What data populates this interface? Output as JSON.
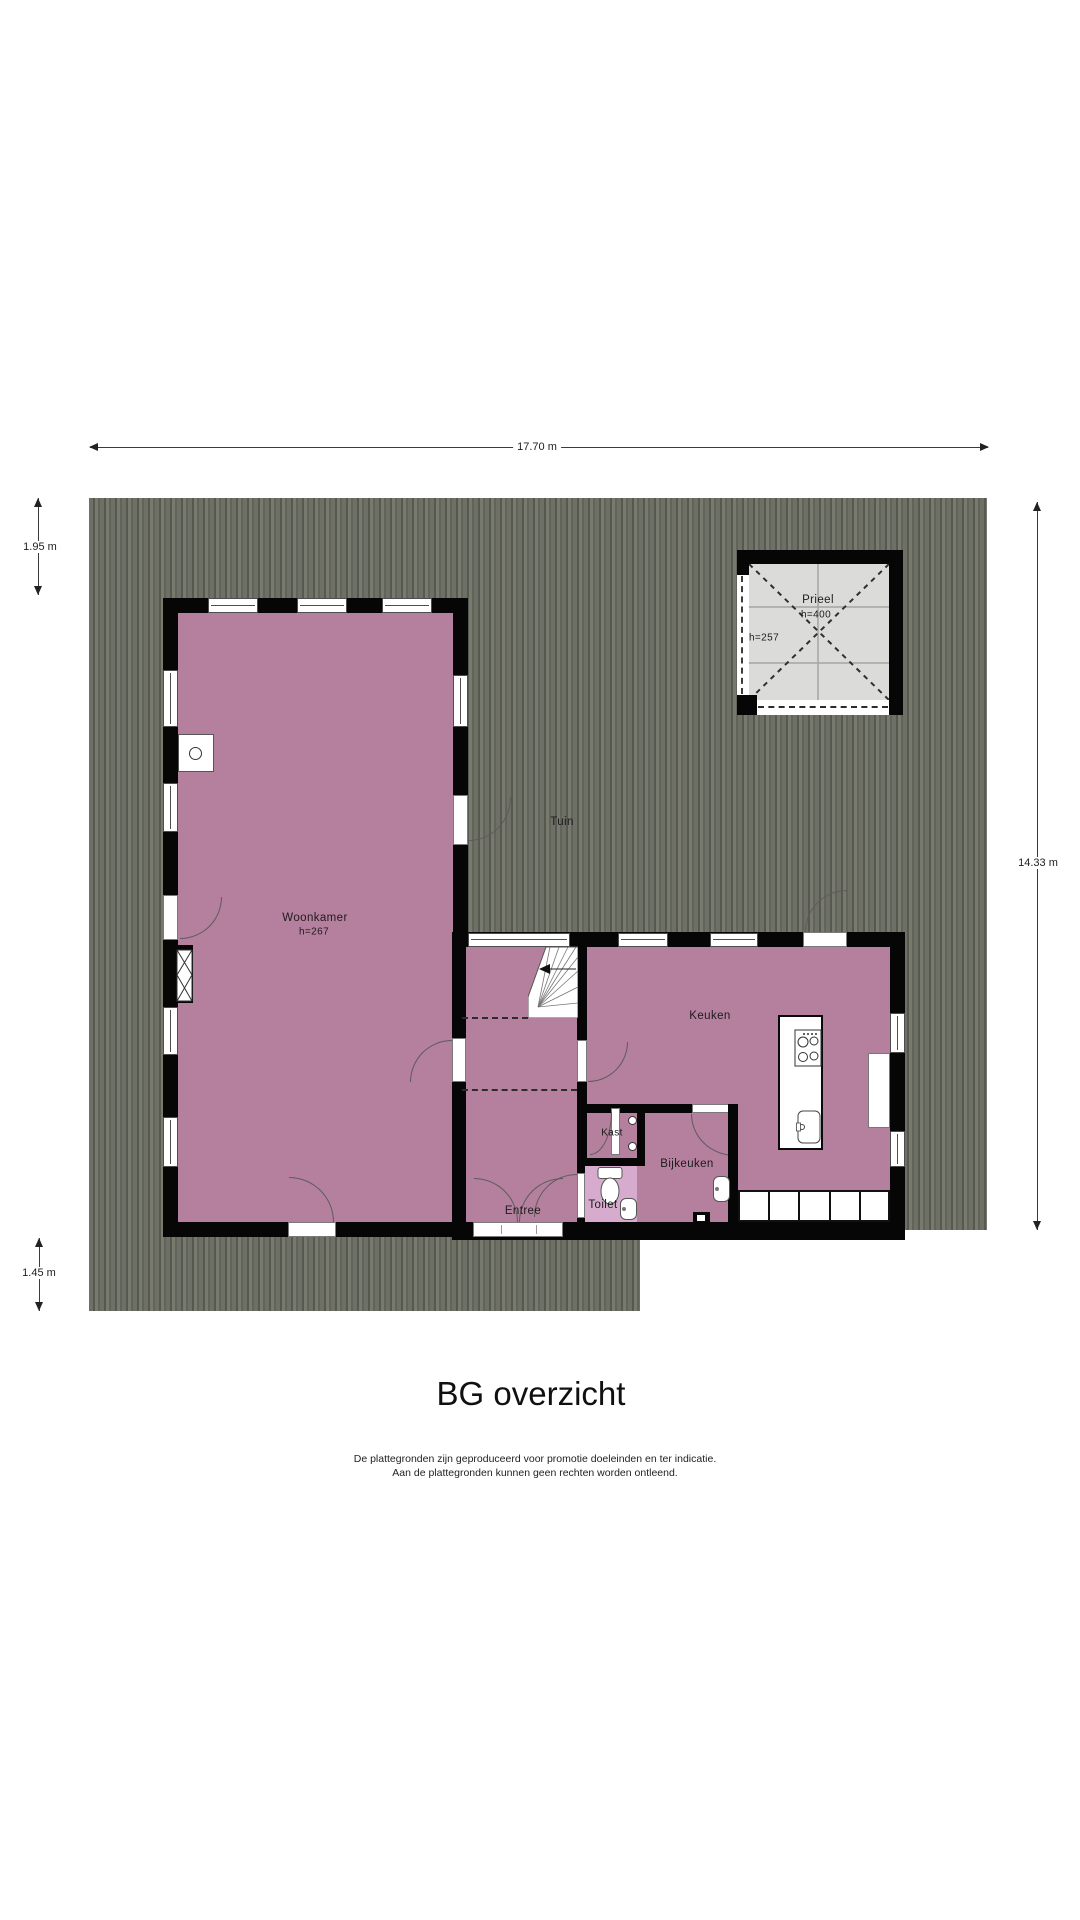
{
  "title": "BG overzicht",
  "disclaimer": {
    "line1": "De plattegronden zijn geproduceerd voor promotie doeleinden en ter indicatie.",
    "line2": "Aan de plattegronden kunnen geen rechten worden ontleend."
  },
  "dimensions": {
    "width_top": "17.70 m",
    "left_upper": "1.95 m",
    "left_lower": "1.45 m",
    "height_right": "14.33 m"
  },
  "rooms": {
    "tuin": {
      "label": "Tuin"
    },
    "woonkamer": {
      "label": "Woonkamer",
      "ceiling_height": "h=267"
    },
    "keuken": {
      "label": "Keuken"
    },
    "bijkeuken": {
      "label": "Bijkeuken"
    },
    "entree": {
      "label": "Entree"
    },
    "toilet": {
      "label": "Toilet"
    },
    "kast": {
      "label": "Kast"
    },
    "prieel": {
      "label": "Prieel",
      "ceiling_height": "h=400",
      "height_secondary": "h=257"
    }
  },
  "colors": {
    "room_floor": "#b57f9e",
    "toilet_floor": "#d6abcd",
    "garden": "#6e7065",
    "prieel_floor": "#dbdbd9",
    "wall": "#060606"
  }
}
